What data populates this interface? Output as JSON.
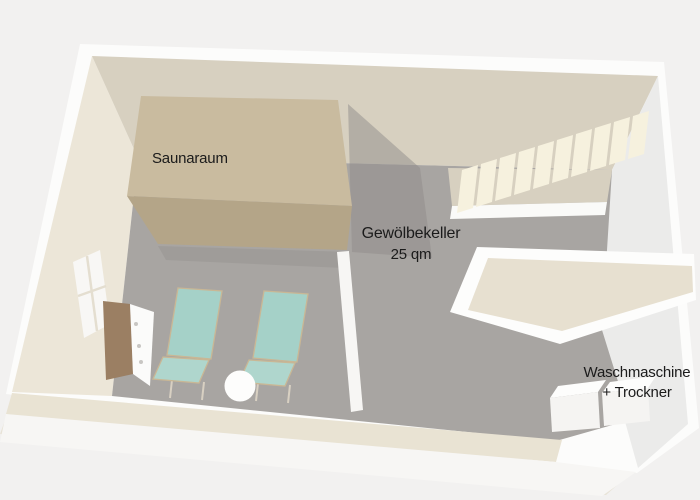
{
  "plan": {
    "labels": {
      "sauna_room": "Saunaraum",
      "vaulted_cellar": {
        "line1": "Gewölbekeller",
        "line2": "25 qm"
      },
      "laundry": {
        "line1": "Waschmaschine",
        "line2": "+ Trockner"
      }
    },
    "colors": {
      "background": "#f2f1f0",
      "room_shadow": "#e8e3d7",
      "outer_wall": "#fcfcfb",
      "back_wall": "#d7d0c0",
      "left_wall": "#ece6d8",
      "right_wall": "#ebebea",
      "floor": "#a8a5a2",
      "stair_landing": "#d7d0c0",
      "stair_edge": "#fafaf8",
      "stair_step": "#f6f1de",
      "slab_edge": "#fdfdfc",
      "slab_top": "#e7e0d0",
      "sauna_top": "#c9bb9f",
      "sauna_front": "#b4a588",
      "sauna_shadow": "#8f8c89",
      "partition_wall": "#f7f6f4",
      "window_glass": "#f8f7f5",
      "cabinet_wood": "#9b7f63",
      "cabinet_body": "#fbfbfa",
      "cabinet_knob": "#c8c6c3",
      "chair_fabric": "#a5d1c8",
      "chair_seat": "#afd6cd",
      "side_table": "#fdfdfc",
      "appliance_front": "#f5f4f2",
      "appliance_top": "#fdfdfc",
      "bottom_wall_top": "#e9e3d3",
      "bottom_wall_front": "#f7f6f4",
      "label_text": "#1b1b1b"
    }
  }
}
